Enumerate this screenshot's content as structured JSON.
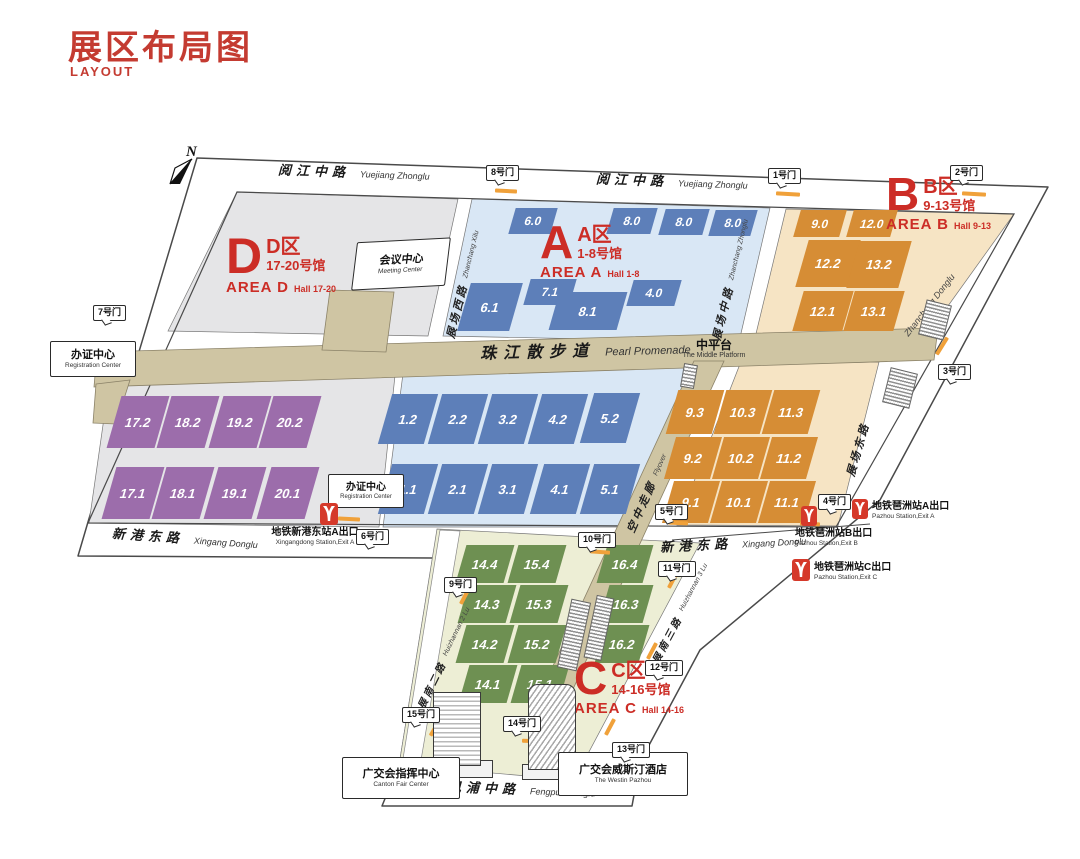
{
  "header": {
    "title": "展区布局图",
    "subtitle": "LAYOUT"
  },
  "compass": {
    "label": "N"
  },
  "areas": {
    "a": {
      "letter": "A",
      "name_zh": "A区",
      "halls_zh": "1-8号馆",
      "name_en": "AREA A",
      "halls_en": "Hall 1-8"
    },
    "b": {
      "letter": "B",
      "name_zh": "B区",
      "halls_zh": "9-13号馆",
      "name_en": "AREA B",
      "halls_en": "Hall 9-13"
    },
    "c": {
      "letter": "C",
      "name_zh": "C区",
      "halls_zh": "14-16号馆",
      "name_en": "AREA C",
      "halls_en": "Hall 14-16"
    },
    "d": {
      "letter": "D",
      "name_zh": "D区",
      "halls_zh": "17-20号馆",
      "name_en": "AREA D",
      "halls_en": "Hall 17-20"
    }
  },
  "halls": {
    "a_top": [
      "6.0",
      "8.0",
      "8.0",
      "8.0"
    ],
    "a_mid": [
      "6.1",
      "7.1",
      "8.1",
      "4.0"
    ],
    "a2": [
      "1.2",
      "2.2",
      "3.2",
      "4.2",
      "5.2"
    ],
    "a1": [
      "1.1",
      "2.1",
      "3.1",
      "4.1",
      "5.1"
    ],
    "b_top": [
      "9.0",
      "12.0"
    ],
    "b2": [
      "12.2",
      "13.2"
    ],
    "b1": [
      "12.1",
      "13.1"
    ],
    "bl3": [
      "9.3",
      "10.3",
      "11.3"
    ],
    "bl2": [
      "9.2",
      "10.2",
      "11.2"
    ],
    "bl1": [
      "9.1",
      "10.1",
      "11.1"
    ],
    "c4": [
      "14.4",
      "15.4",
      "16.4"
    ],
    "c3": [
      "14.3",
      "15.3",
      "16.3"
    ],
    "c2": [
      "14.2",
      "15.2",
      "16.2"
    ],
    "c1": [
      "14.1",
      "15.1"
    ],
    "d2": [
      "17.2",
      "18.2",
      "19.2",
      "20.2"
    ],
    "d1": [
      "17.1",
      "18.1",
      "19.1",
      "20.1"
    ]
  },
  "gates": [
    "1号门",
    "2号门",
    "3号门",
    "4号门",
    "5号门",
    "6号门",
    "7号门",
    "8号门",
    "9号门",
    "10号门",
    "11号门",
    "12号门",
    "13号门",
    "14号门",
    "15号门"
  ],
  "roads": {
    "yuejiang": {
      "zh": "阅江中路",
      "en": "Yuejiang Zhonglu"
    },
    "xingang": {
      "zh": "新港东路",
      "en": "Xingang Donglu"
    },
    "fengpu": {
      "zh": "凤浦中路",
      "en": "Fengpu Zhonglu"
    },
    "zhanchang_xi": {
      "zh": "展场西路",
      "en": "Zhanchang Xilu"
    },
    "zhanchang_zhong": {
      "zh": "展场中路",
      "en": "Zhanchang Zhonglu"
    },
    "zhanchang_dong": {
      "zh": "展场东路",
      "en": "Zhanchang Donglu"
    },
    "huizhan2": {
      "zh": "会展南二路",
      "en": "Huizhannan 2 Lu"
    },
    "huizhan3": {
      "zh": "会展南三路",
      "en": "Huizhannan 3 Lu"
    },
    "promenade": {
      "zh": "珠江散步道",
      "en": "Pearl Promenade"
    },
    "platform": {
      "zh": "中平台",
      "en": "The Middle Platform"
    },
    "flyover": {
      "zh": "空中走廊",
      "en": "Flyover"
    }
  },
  "facilities": {
    "meeting": {
      "zh": "会议中心",
      "en": "Meeting Center"
    },
    "registration": {
      "zh": "办证中心",
      "en": "Registration Center"
    },
    "command": {
      "zh": "广交会指挥中心",
      "en": "Canton Fair Center"
    },
    "westin": {
      "zh": "广交会威斯汀酒店",
      "en": "The Westin Pazhou"
    }
  },
  "metro": {
    "xingangdong_a": {
      "zh": "地铁新港东站A出口",
      "en": "Xingangdong Station,Exit A"
    },
    "pazhou_a": {
      "zh": "地铁琶洲站A出口",
      "en": "Pazhou Station,Exit A"
    },
    "pazhou_b": {
      "zh": "地铁琶洲站B出口",
      "en": "Pazhou Station,Exit B"
    },
    "pazhou_c": {
      "zh": "地铁琶洲站C出口",
      "en": "Pazhou Station,Exit C"
    }
  },
  "colors": {
    "accent_red": "#c43b31",
    "area_label_red": "#cc2d26",
    "area_a_fill": "#d9e7f5",
    "area_b_fill": "#f6e4c4",
    "area_c_fill": "#edeed5",
    "area_d_fill": "#e5e5e7",
    "hall_blue": "#5d7fb9",
    "hall_orange": "#d68d35",
    "hall_green": "#6e9052",
    "hall_purple": "#9c6dab",
    "promenade_tan": "#cfc5a3",
    "metro_red": "#d5392a",
    "gate_mark_orange": "#f0a13a"
  }
}
